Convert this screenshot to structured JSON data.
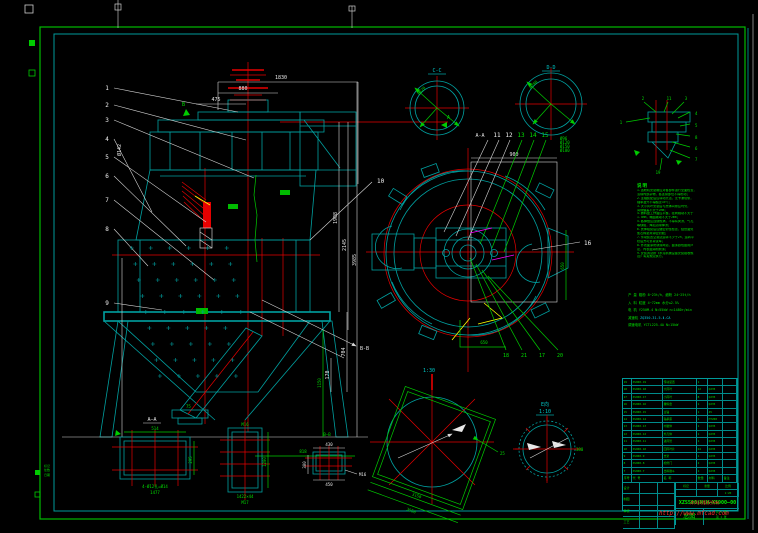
{
  "colors": {
    "background": "#000000",
    "frame_outer": "#00bb00",
    "frame_inner": "#009a9a",
    "machine_line": "#00a0a0",
    "dimension": "#e8e8e8",
    "centerline": "#e60000",
    "annotation_green": "#00dd00",
    "magenta_detail": "#ff00ff",
    "yellow_detail": "#ffff00",
    "watermark_red": "#ff2a2a"
  },
  "front_view": {
    "balloons": [
      "1",
      "2",
      "3",
      "4",
      "5",
      "6",
      "7",
      "8",
      "9"
    ],
    "balloon10": "10",
    "bb_label": "B-B",
    "a_label": "A",
    "b_label": "B",
    "dim_1830": "1830",
    "dim_880": "880",
    "dim_475": "475",
    "dim_phi": "Ø142",
    "dim_r1": "1908",
    "dim_r2": "2145",
    "dim_r3": "3985",
    "dim_r4": "704",
    "dim_r5": "170",
    "dim_1150": "1150",
    "dim_818": "818",
    "dim_75": "75"
  },
  "plan_view": {
    "label": "A-A",
    "b11": "11",
    "b12": "12",
    "b13": "13",
    "b14": "14",
    "b15": "15",
    "b16": "16",
    "dim_top": "900",
    "dim_right": "650",
    "dim_bottom": "650",
    "g18": "18",
    "g21": "21",
    "g17": "17",
    "g20": "20",
    "stack": [
      "Ø96",
      "Ø120",
      "Ø150",
      "Ø180"
    ]
  },
  "circle_c": {
    "label": "C-C",
    "dim": "Ø620"
  },
  "circle_d": {
    "label": "D-D",
    "dim": "Ø780"
  },
  "mini": {
    "b1": "1",
    "b2": "2",
    "b11": "11",
    "b3": "3",
    "b4": "4",
    "b5": "5",
    "b8": "8",
    "b6": "6",
    "b7": "7",
    "b19": "19"
  },
  "notes": {
    "title": "说明",
    "lines": [
      "1.选粉机安装前应对各部件进行全面检查，",
      "  清除内部杂物，各连接部位不得松动；",
      "2.主轴装配后应转动灵活，无卡滞现象，",
      "  轴承温升不得超过35℃；",
      "3.大小风叶安装后与壳体间隙应均匀，",
      "  间隙偏差不大于2mm；",
      "4.撒料盘工作面应平整，径向跳动不大于",
      "  1.5mm，端面跳动不大于2mm；",
      "5.各焊缝应连续饱满，不得有夹渣、气孔",
      "  等缺陷，焊后清除焊渣；",
      "6.壳体组装后应做密封性检查，结合面处",
      "  加石棉垫并涂密封胶；",
      "7.传动装置空载试运转不少于2h，运转平",
      "  稳后方可负荷试车；",
      "8.外表面涂防锈漆两道，面漆颜色由用户",
      "  定，内表面涂耐磨漆；",
      "9.安装调试按《水泥机械设备安装验收规",
      "  范》有关规定执行。"
    ]
  },
  "params": {
    "rows": [
      {
        "l": "产 量",
        "v": "粗粉 8~23t/h，细粉 24~25t/h",
        "c": "g"
      },
      {
        "l": "入 料",
        "v": "粒度 4~72mm  水分≤2.5%",
        "c": "g"
      },
      {
        "l": "电 机",
        "v": "Y250M-4  N=55kW  n=1480r/min",
        "c": "g"
      },
      {
        "l": "减速机",
        "v": "ZQ350-31.5-Ⅱ-CA",
        "c": "c"
      },
      {
        "l": "调速电机",
        "v": "YCTL225-4A  N=15kW",
        "c": "g"
      }
    ]
  },
  "details": {
    "d1": {
      "label": "A—A",
      "t": "514",
      "r": "295",
      "b1": "4-Ø12孔=Ø14",
      "b2": "1477"
    },
    "d2": {
      "t": "M16",
      "r": "1200",
      "b1": "1422×44",
      "b2": "M17"
    },
    "d3": {
      "label": "B—B",
      "t": "430",
      "b": "450",
      "l": "300",
      "leader": "M16"
    },
    "big": {
      "scale": "1:30",
      "d1": "3150",
      "d2": "3550",
      "r": "25"
    },
    "e": {
      "label": "E向",
      "scale": "1:10",
      "dim": "380"
    }
  },
  "bom": {
    "header": [
      "序号",
      "代  号",
      "名  称",
      "数量",
      "材料",
      "备注"
    ],
    "rows": [
      [
        "19",
        "XS900-19",
        "传动装置",
        "1",
        "",
        ""
      ],
      [
        "18",
        "XS900-18",
        "大风叶",
        "12",
        "Q235",
        ""
      ],
      [
        "17",
        "XS900-17",
        "小风叶",
        "8",
        "Q235",
        ""
      ],
      [
        "16",
        "XS900-16",
        "撒料盘",
        "1",
        "Q235",
        ""
      ],
      [
        "15",
        "XS900-15",
        "主轴",
        "1",
        "45",
        ""
      ],
      [
        "14",
        "XS900-14",
        "轴承座",
        "1",
        "HT200",
        ""
      ],
      [
        "13",
        "XS900-13",
        "内锥体",
        "1",
        "Q235",
        ""
      ],
      [
        "12",
        "XS900-12",
        "外壳体",
        "1",
        "Q235",
        ""
      ],
      [
        "11",
        "XS900-11",
        "进风管",
        "1",
        "Q235",
        ""
      ],
      [
        "10",
        "XS900-10",
        "回风叶片",
        "24",
        "Q235",
        ""
      ],
      [
        "9",
        "XS900-9",
        "支架",
        "1",
        "Q235",
        ""
      ],
      [
        "8",
        "XS900-8",
        "检修门",
        "2",
        "Q235",
        ""
      ],
      [
        "7",
        "XS900-7",
        "出料锥斗",
        "1",
        "Q235",
        ""
      ]
    ]
  },
  "title_block": {
    "sig": [
      "设计",
      "制图",
      "审核",
      "工艺"
    ],
    "cells_top": [
      "标记",
      "重量",
      "比例"
    ],
    "scale": "1:20",
    "drawing_no": "XZS500(N)H—XS900—00",
    "name": "总图",
    "sheet1": "共 1 张",
    "sheet2": "第 1 张",
    "stamp": "沐风网版权所有",
    "url": "http://www.mfcad.com"
  },
  "corner": {
    "m1": "标记",
    "m2": "处数",
    "m3": "日期"
  }
}
